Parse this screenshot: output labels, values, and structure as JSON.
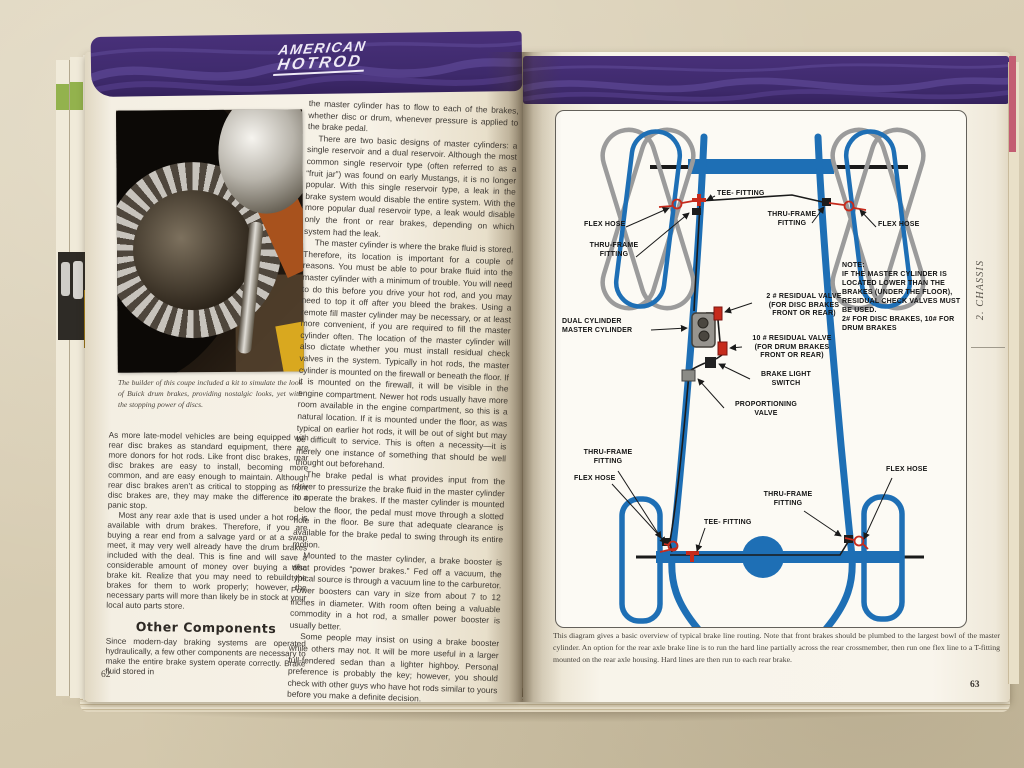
{
  "logo": {
    "line1": "AMERICAN",
    "line2": "HOTROD"
  },
  "left_page": {
    "page_number": "62",
    "photo_caption": "The builder of this coupe included a kit to simulate the look of Buick drum brakes, providing nostalgic looks, yet with the stopping power of discs.",
    "text_column": {
      "p1": "the master cylinder has to flow to each of the brakes, whether disc or drum, whenever pressure is applied to the brake pedal.",
      "p2": "There are two basic designs of master cylinders: a single reservoir and a dual reservoir. Although the most common single reservoir type (often referred to as a “fruit jar”) was found on early Mustangs, it is no longer popular. With this single reservoir type, a leak in the brake system would disable the entire system. With the more popular dual reservoir type, a leak would disable only the front or rear brakes, depending on which system had the leak.",
      "p3": "The master cylinder is where the brake fluid is stored. Therefore, its location is important for a couple of reasons. You must be able to pour brake fluid into the master cylinder with a minimum of trouble. You will need to do this before you drive your hot rod, and you may need to top it off after you bleed the brakes. Using a remote fill master cylinder may be necessary, or at least more convenient, if you are required to fill the master cylinder often. The location of the master cylinder will also dictate whether you must install residual check valves in the system. Typically in hot rods, the master cylinder is mounted on the firewall or beneath the floor. If it is mounted on the firewall, it will be visible in the engine compartment. Newer hot rods usually have more room available in the engine compartment, so this is a natural location. If it is mounted under the floor, as was typical on earlier hot rods, it will be out of sight but may be difficult to service. This is often a necessity—it is merely one instance of something that should be well thought out beforehand.",
      "p4": "The brake pedal is what provides input from the driver to pressurize the brake fluid in the master cylinder to operate the brakes. If the master cylinder is mounted below the floor, the pedal must move through a slotted hole in the floor. Be sure that adequate clearance is available for the brake pedal to swing through its entire motion.",
      "p5": "Mounted to the master cylinder, a brake booster is what provides “power brakes.” Fed off a vacuum, the typical source is through a vacuum line to the carburetor. Power boosters can vary in size from about 7 to 12 inches in diameter. With room often being a valuable commodity in a hot rod, a smaller power booster is usually better.",
      "p6": "Some people may insist on using a brake booster while others may not. It will be more useful in a larger full-fendered sedan than a lighter highboy. Personal preference is probably the key; however, you should check with other guys who have hot rods similar to yours before you make a definite decision.",
      "p7": "The proportioning valve is mounted inline with the rear brake line. A knob allows you to open or close the valve"
    },
    "lower_column": {
      "p1": "As more late-model vehicles are being equipped with rear disc brakes as standard equipment, there are more donors for hot rods. Like front disc brakes, rear disc brakes are easy to install, becoming more common, and are easy enough to maintain. Although rear disc brakes aren’t as critical to stopping as front disc brakes are, they may make the difference in a panic stop.",
      "p2": "Most any rear axle that is used under a hot rod is available with drum brakes. Therefore, if you are buying a rear end from a salvage yard or at a swap meet, it may very well already have the drum brakes included with the deal. This is fine and will save a considerable amount of money over buying a disc brake kit. Realize that you may need to rebuild the brakes for them to work properly; however, the necessary parts will more than likely be in stock at your local auto parts store.",
      "heading": "Other Components",
      "p3": "Since modern-day braking systems are operated hydraulically, a few other components are necessary to make the entire brake system operate correctly. Brake fluid stored in"
    }
  },
  "right_page": {
    "page_number": "63",
    "side_tab": "2. CHASSIS",
    "diagram_labels": {
      "tee_front": "TEE- FITTING",
      "flex_hose_front_left": "FLEX HOSE",
      "thru_frame_front_left": "THRU-FRAME\nFITTING",
      "thru_frame_front_right": "THRU-FRAME\nFITTING",
      "flex_hose_front_right": "FLEX HOSE",
      "master_cylinder": "DUAL CYLINDER\nMASTER CYLINDER",
      "residual_valve_2": "2 # RESIDUAL VALVE\n(FOR DISC BRAKES\nFRONT OR REAR)",
      "residual_valve_10": "10 # RESIDUAL VALVE\n(FOR DRUM BRAKES\nFRONT OR REAR)",
      "brake_light_switch": "BRAKE LIGHT\nSWITCH",
      "proportioning_valve": "PROPORTIONING\nVALVE",
      "note": "NOTE:\nIF THE MASTER CYLINDER IS\nLOCATED LOWER THAN THE\nBRAKES (UNDER THE FLOOR),\nRESIDUAL CHECK VALVES MUST\nBE USED.\n2# FOR DISC BRAKES, 10# FOR\nDRUM BRAKES",
      "thru_frame_rear_left": "THRU-FRAME\nFITTING",
      "flex_hose_rear_left": "FLEX HOSE",
      "tee_rear": "TEE- FITTING",
      "thru_frame_rear_right": "THRU-FRAME\nFITTING",
      "flex_hose_rear_right": "FLEX HOSE"
    },
    "caption": "This diagram gives a basic overview of typical brake line routing. Note that front brakes should be plumbed to the largest bowl of the master cylinder. An option for the rear axle brake line is to run the hard line partially across the rear crossmember, then run one flex line to a T-fitting mounted on the rear axle housing. Hard lines are then run to each rear brake."
  },
  "colors": {
    "band_purple": "#3f2a6c",
    "chassis_blue": "#1e6fb5",
    "line_red": "#c62b1c"
  }
}
